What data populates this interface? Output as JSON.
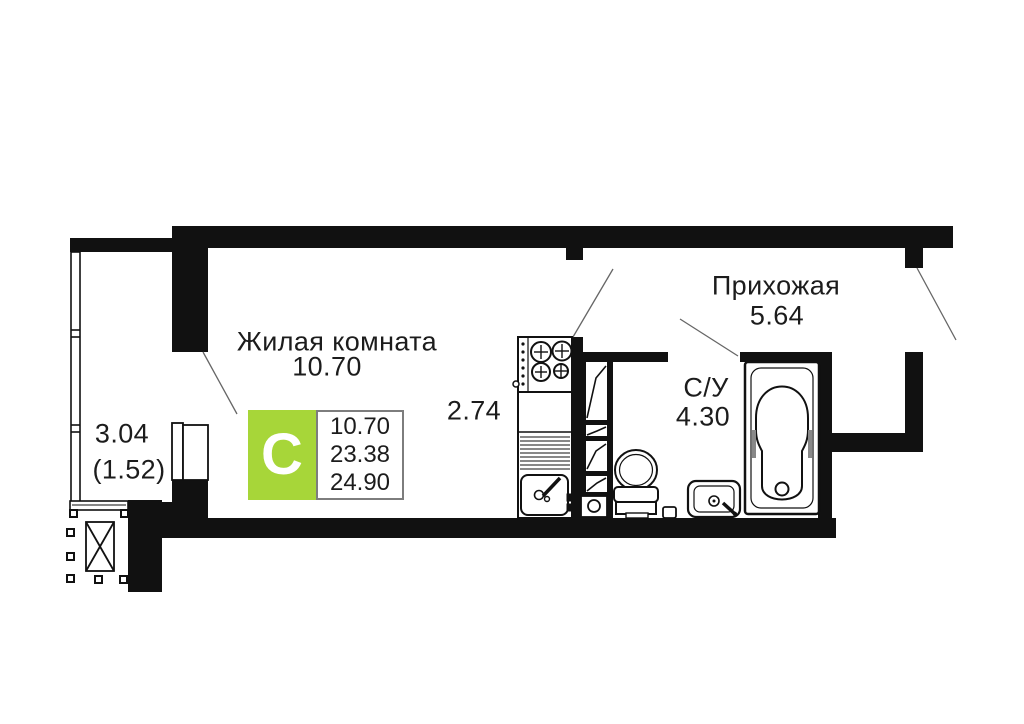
{
  "rooms": {
    "living": {
      "label": "Жилая комната",
      "area": "10.70"
    },
    "kitchen": {
      "area": "2.74"
    },
    "hallway": {
      "label": "Прихожая",
      "area": "5.64"
    },
    "bathroom": {
      "label": "С/У",
      "area": "4.30"
    },
    "balcony": {
      "area": "3.04",
      "area_coef": "(1.52)"
    }
  },
  "badge": {
    "letter": "С",
    "color": "#a7d639",
    "areas": [
      "10.70",
      "23.38",
      "24.90"
    ]
  },
  "colors": {
    "wall": "#111111",
    "line": "#666666",
    "text": "#1c1c1c"
  }
}
